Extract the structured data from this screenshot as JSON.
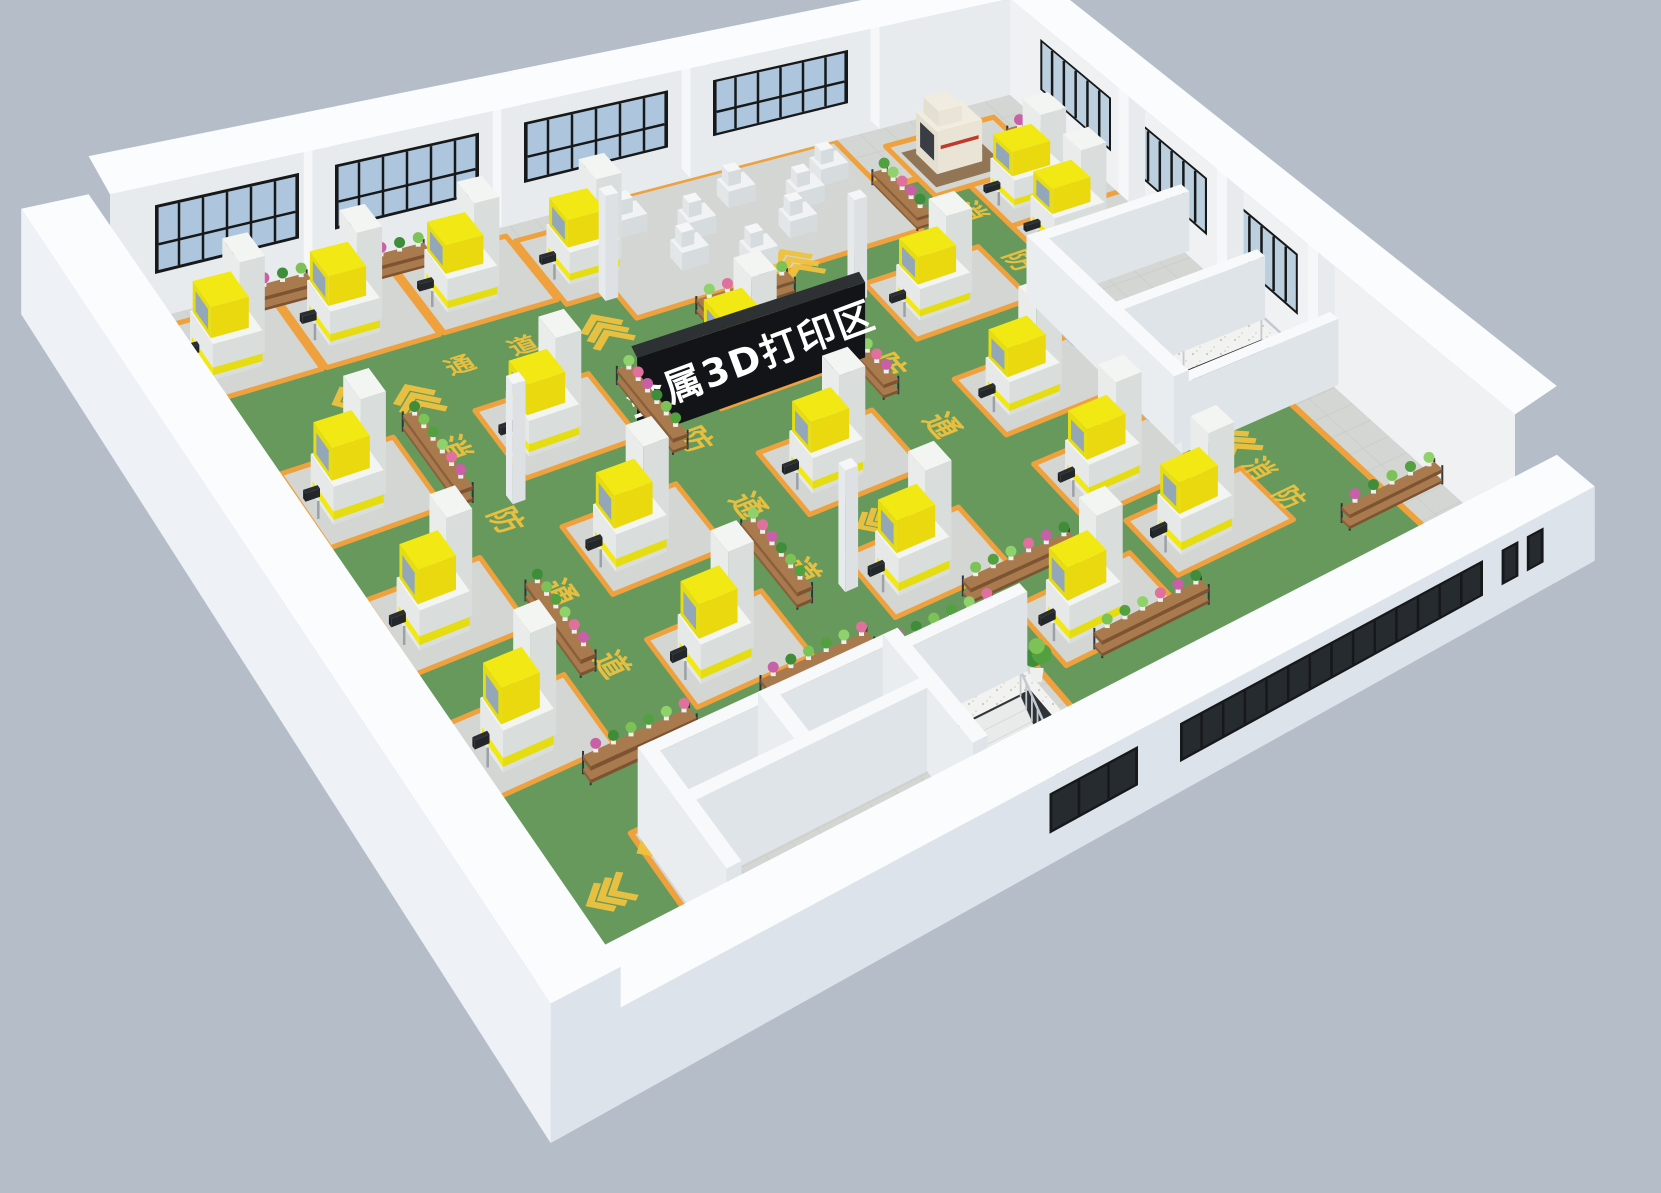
{
  "scene": {
    "type": "isometric-3d-factory-floor-plan-render",
    "zone_sign": {
      "text": "金属3D打印区"
    },
    "floor_marking": {
      "label": "消防通道",
      "chars": [
        "消",
        "防",
        "通",
        "道"
      ]
    },
    "counts": {
      "metal_3d_printers": 20,
      "small_machines": 8,
      "cnc_machines": 1,
      "plant_racks": 17,
      "staircases": 2,
      "columns": 4,
      "doors": 2,
      "potted_plants": 3
    }
  },
  "colors": {
    "background": "#b5bdc9",
    "wall_outer": "#eef2f7",
    "wall_inner": "#e8ebee",
    "wall_front_face": "#dde3ea",
    "wall_top": "#fafcfd",
    "pilaster": "#f5f7f9",
    "floor_tile": "#d3d6d2",
    "tile_grout": "#c6c9c5",
    "lane_green": "#67995c",
    "lane_border_orange": "#efa13e",
    "marking_yellow": "#eec23f",
    "machine_top": "#f3f5f3",
    "machine_left": "#e6e9e8",
    "machine_front": "#d9dedd",
    "hood_yellow": "#f2e813",
    "hood_yellow_side": "#e6dc12",
    "hood_window": "#93a7b9",
    "small_machine_top": "#f0f2f3",
    "small_machine_left": "#e2e6e8",
    "small_machine_front": "#d6dbde",
    "cnc_beige": "#e9e4d6",
    "cnc_panel": "#3a3e44",
    "cnc_red": "#c0392b",
    "cnc_mat": "#8a6a47",
    "glass_back": "#adc6dd",
    "glass_right": "#bccfde",
    "glass_dark": "#262b2f",
    "window_frame": "#16181a",
    "sign_board": "#121417",
    "sign_top": "#2e3134",
    "sign_pole": "#1d1f22",
    "sign_text": "#ffffff",
    "rack_wood_top": "#a97a4e",
    "rack_wood_front": "#8a5f3a",
    "rack_frame": "#32363a",
    "plant_palette": [
      "#53a041",
      "#7cc256",
      "#3f8c3b",
      "#c95fa6",
      "#e0719e",
      "#8fd16a"
    ],
    "pot": "#eef0ef",
    "stair_tread": "#e9ebea",
    "stair_pit": "#2f3337",
    "railing": "#c3c9cf",
    "terrazzo": "#f2f3f1",
    "terrazzo_dot": "#c8c8c2",
    "door": "#e4e8eb",
    "door_frame": "#b9c2c9",
    "exit_sign_green": "#27b35e"
  },
  "layout": {
    "floor_quad": {
      "w": [
        110,
        330
      ],
      "n": [
        1010,
        95
      ],
      "e": [
        1515,
        550
      ],
      "s": [
        585,
        1050
      ]
    },
    "wall_height_back": 175,
    "wall_height_front": 95,
    "window_z": [
      58,
      148
    ],
    "front_window_z": [
      34,
      78
    ],
    "back_left_windows": [
      [
        0.05,
        0.21
      ],
      [
        0.25,
        0.41
      ],
      [
        0.46,
        0.62
      ],
      [
        0.67,
        0.82
      ]
    ],
    "back_right_windows": [
      [
        0.06,
        0.2
      ],
      [
        0.25,
        0.39
      ],
      [
        0.45,
        0.57
      ]
    ],
    "pilasters_back_left": [
      0.225,
      0.435,
      0.645,
      0.855
    ],
    "pilasters_back_right": [
      0.215,
      0.41,
      0.59
    ],
    "front_small_window": [
      0.46,
      0.555
    ],
    "front_ribbon_window": [
      0.6,
      0.925
    ],
    "front_square_windows": [
      [
        0.945,
        0.963
      ],
      [
        0.972,
        0.99
      ]
    ],
    "green_area": [
      [
        0.03,
        0.095
      ],
      [
        0.955,
        0.095
      ],
      [
        0.955,
        0.315
      ],
      [
        0.835,
        0.315
      ],
      [
        0.835,
        0.625
      ],
      [
        0.955,
        0.625
      ],
      [
        0.955,
        0.93
      ],
      [
        0.575,
        0.93
      ],
      [
        0.575,
        0.795
      ],
      [
        0.155,
        0.795
      ],
      [
        0.155,
        0.93
      ],
      [
        0.03,
        0.93
      ]
    ],
    "printers": [
      [
        0.065,
        0.045
      ],
      [
        0.195,
        0.045
      ],
      [
        0.325,
        0.045
      ],
      [
        0.455,
        0.055
      ],
      [
        0.085,
        0.26
      ],
      [
        0.3,
        0.26
      ],
      [
        0.515,
        0.26
      ],
      [
        0.73,
        0.26
      ],
      [
        0.9,
        0.22
      ],
      [
        0.085,
        0.44
      ],
      [
        0.3,
        0.44
      ],
      [
        0.515,
        0.44
      ],
      [
        0.73,
        0.44
      ],
      [
        0.085,
        0.615
      ],
      [
        0.3,
        0.615
      ],
      [
        0.515,
        0.615
      ],
      [
        0.73,
        0.6
      ],
      [
        0.615,
        0.775
      ],
      [
        0.76,
        0.73
      ],
      [
        0.9,
        0.14
      ]
    ],
    "pad_size": [
      0.125,
      0.105
    ],
    "pad_offset": [
      0.017,
      0.032
    ],
    "extra_pads": [
      [
        0.49,
        0.0,
        0.315,
        0.175
      ],
      [
        0.845,
        0.03,
        0.12,
        0.1
      ]
    ],
    "small_machines": [
      [
        0.535,
        0.035
      ],
      [
        0.595,
        0.065
      ],
      [
        0.655,
        0.035
      ],
      [
        0.715,
        0.065
      ],
      [
        0.565,
        0.105
      ],
      [
        0.685,
        0.105
      ],
      [
        0.755,
        0.04
      ],
      [
        0.625,
        0.135
      ]
    ],
    "cnc_machine": [
      0.865,
      0.055
    ],
    "racks": [
      [
        "a",
        0.15,
        0.012,
        0.062
      ],
      [
        "a",
        0.28,
        0.012,
        0.062
      ],
      [
        "a",
        0.545,
        0.195,
        0.1
      ],
      [
        "b",
        0.8,
        0.085,
        0.09
      ],
      [
        "b",
        0.205,
        0.225,
        0.115
      ],
      [
        "b",
        0.425,
        0.255,
        0.115
      ],
      [
        "b",
        0.64,
        0.285,
        0.115
      ],
      [
        "b",
        0.035,
        0.16,
        0.115
      ],
      [
        "b",
        0.205,
        0.48,
        0.115
      ],
      [
        "b",
        0.425,
        0.51,
        0.115
      ],
      [
        "a",
        0.15,
        0.705,
        0.115
      ],
      [
        "a",
        0.34,
        0.71,
        0.115
      ],
      [
        "a",
        0.565,
        0.7,
        0.115
      ],
      [
        "a",
        0.46,
        0.74,
        0.115
      ],
      [
        "a",
        0.63,
        0.845,
        0.115
      ],
      [
        "a",
        0.9,
        0.84,
        0.1
      ],
      [
        "b",
        0.955,
        0.075,
        0.08
      ]
    ],
    "columns": [
      [
        0.475,
        0.125
      ],
      [
        0.255,
        0.345
      ],
      [
        0.475,
        0.615
      ],
      [
        0.69,
        0.235
      ]
    ],
    "potted_plants": [
      [
        0.818,
        0.4
      ],
      [
        0.818,
        0.565
      ],
      [
        0.565,
        0.85
      ]
    ],
    "rooms_bottom_left": {
      "walls": [
        [
          "a",
          0.16,
          0.8,
          0.425
        ],
        [
          "b",
          0.16,
          0.8,
          0.985
        ],
        [
          "a",
          0.16,
          0.875,
          0.425
        ],
        [
          "b",
          0.29,
          0.8,
          0.875
        ],
        [
          "b",
          0.425,
          0.8,
          0.985
        ],
        [
          "a",
          0.425,
          0.815,
          0.565
        ]
      ],
      "landing": [
        0.43,
        0.81,
        0.565,
        0.99
      ],
      "pit": [
        0.465,
        0.855,
        0.555,
        0.975
      ],
      "stair_a": [
        0.465,
        0.545
      ],
      "stair_b0": 0.855,
      "steps": 10
    },
    "rooms_right": {
      "walls": [
        [
          "b",
          0.835,
          0.33,
          0.625
        ],
        [
          "a",
          0.835,
          0.33,
          1.005
        ],
        [
          "a",
          0.835,
          0.48,
          1.005
        ],
        [
          "a",
          0.835,
          0.625,
          1.005
        ]
      ],
      "landing": [
        0.855,
        0.49,
        1.0,
        0.625
      ],
      "pit": [
        0.9,
        0.525,
        0.985,
        0.615
      ],
      "doors": [
        {
          "b": 0.365,
          "w": 0.06,
          "exit": false
        },
        {
          "b": 0.515,
          "w": 0.06,
          "exit": true
        }
      ]
    },
    "sign": {
      "a0": 0.375,
      "a1": 0.625,
      "b": 0.39,
      "z0": 58,
      "z1": 162,
      "poles": [
        0.4,
        0.6
      ]
    },
    "markings": [
      {
        "k": "c",
        "ax": "b",
        "a": 0.047,
        "b": 0.3,
        "ch": "消",
        "s": 24
      },
      {
        "k": "c",
        "ax": "b",
        "a": 0.047,
        "b": 0.42,
        "ch": "防",
        "s": 24
      },
      {
        "k": "c",
        "ax": "b",
        "a": 0.047,
        "b": 0.54,
        "ch": "通",
        "s": 24
      },
      {
        "k": "c",
        "ax": "b",
        "a": 0.047,
        "b": 0.66,
        "ch": "道",
        "s": 24
      },
      {
        "k": "v",
        "ax": "b",
        "a": 0.238,
        "b": 0.19,
        "s": 20
      },
      {
        "k": "c",
        "ax": "b",
        "a": 0.238,
        "b": 0.265,
        "ch": "消",
        "s": 34
      },
      {
        "k": "c",
        "ax": "b",
        "a": 0.238,
        "b": 0.375,
        "ch": "防",
        "s": 34
      },
      {
        "k": "c",
        "ax": "b",
        "a": 0.238,
        "b": 0.485,
        "ch": "通",
        "s": 34
      },
      {
        "k": "c",
        "ax": "b",
        "a": 0.238,
        "b": 0.595,
        "ch": "道",
        "s": 34
      },
      {
        "k": "v",
        "ax": "b",
        "a": 0.453,
        "b": 0.175,
        "s": 20
      },
      {
        "k": "c",
        "ax": "b",
        "a": 0.453,
        "b": 0.25,
        "ch": "消",
        "s": 34
      },
      {
        "k": "c",
        "ax": "b",
        "a": 0.453,
        "b": 0.36,
        "ch": "防",
        "s": 34
      },
      {
        "k": "c",
        "ax": "b",
        "a": 0.453,
        "b": 0.47,
        "ch": "通",
        "s": 34
      },
      {
        "k": "c",
        "ax": "b",
        "a": 0.453,
        "b": 0.58,
        "ch": "道",
        "s": 34
      },
      {
        "k": "v",
        "ax": "b",
        "a": 0.668,
        "b": 0.165,
        "s": 20
      },
      {
        "k": "c",
        "ax": "b",
        "a": 0.668,
        "b": 0.245,
        "ch": "消",
        "s": 34
      },
      {
        "k": "c",
        "ax": "b",
        "a": 0.668,
        "b": 0.355,
        "ch": "防",
        "s": 34
      },
      {
        "k": "c",
        "ax": "b",
        "a": 0.668,
        "b": 0.465,
        "ch": "通",
        "s": 34
      },
      {
        "k": "c",
        "ax": "b",
        "a": 0.86,
        "b": 0.17,
        "ch": "消",
        "s": 30
      },
      {
        "k": "c",
        "ax": "b",
        "a": 0.86,
        "b": 0.27,
        "ch": "防",
        "s": 30
      },
      {
        "k": "v",
        "ax": "a",
        "a": 0.18,
        "b": 0.165,
        "s": 18
      },
      {
        "k": "c",
        "ax": "a",
        "a": 0.3,
        "b": 0.165,
        "ch": "通",
        "s": 28
      },
      {
        "k": "c",
        "ax": "a",
        "a": 0.37,
        "b": 0.165,
        "ch": "道",
        "s": 28
      },
      {
        "k": "c",
        "ax": "a",
        "a": 0.595,
        "b": 0.565,
        "ch": "道",
        "s": 30
      },
      {
        "k": "v",
        "ax": "a",
        "a": 0.545,
        "b": 0.555,
        "s": 16
      },
      {
        "k": "c",
        "ax": "a",
        "a": 0.26,
        "b": 0.795,
        "ch": "道",
        "s": 46
      },
      {
        "k": "c",
        "ax": "a",
        "a": 0.35,
        "b": 0.788,
        "ch": "通",
        "s": 46
      },
      {
        "k": "c",
        "ax": "a",
        "a": 0.44,
        "b": 0.781,
        "ch": "防",
        "s": 46
      },
      {
        "k": "c",
        "ax": "a",
        "a": 0.53,
        "b": 0.774,
        "ch": "消",
        "s": 46
      },
      {
        "k": "v",
        "ax": "a",
        "a": 0.175,
        "b": 0.82,
        "s": 24
      },
      {
        "k": "v",
        "ax": "a",
        "a": 0.1,
        "b": 0.85,
        "s": 20
      },
      {
        "k": "v",
        "ax": "b",
        "a": 0.88,
        "b": 0.655,
        "s": 20
      },
      {
        "k": "c",
        "ax": "b",
        "a": 0.88,
        "b": 0.71,
        "ch": "消",
        "s": 30
      },
      {
        "k": "c",
        "ax": "b",
        "a": 0.88,
        "b": 0.77,
        "ch": "防",
        "s": 30
      }
    ]
  }
}
